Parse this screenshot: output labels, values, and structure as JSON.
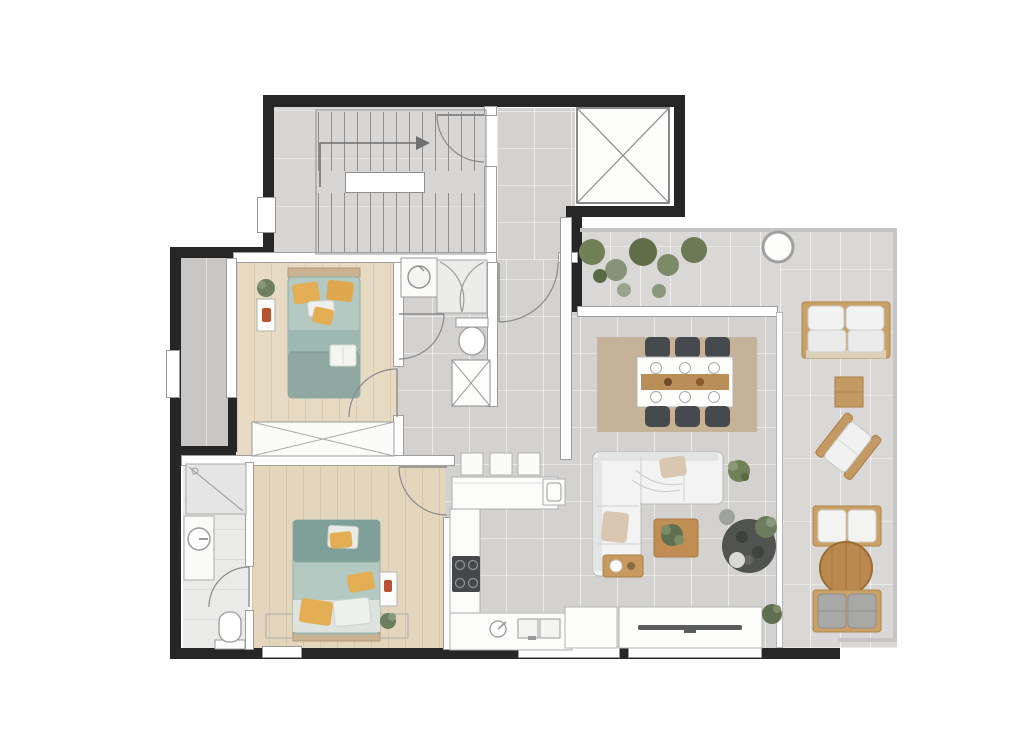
{
  "title": "Two-bedroom apartment floor plan with roof terrace",
  "colors": {
    "exterior_wall": "#262626",
    "interior_wall": "#ffffff",
    "tile_floor": "#d3d2d0",
    "wood_floor": "#e7dbc4",
    "terrace_floor": "#d9d8d6",
    "bedding_teal": "#a9c2bb",
    "bedding_teal_dark": "#7fa099",
    "pillow_yellow": "#e3ae54",
    "dining_rug_tan": "#c6b299",
    "furniture_wood": "#c49a64",
    "chair_dark": "#46494d",
    "plant_green": "#6b7a55"
  },
  "rooms": [
    {
      "id": "staircase-hall",
      "label": "communal staircase"
    },
    {
      "id": "elevator",
      "label": "elevator shaft"
    },
    {
      "id": "entry-corridor",
      "label": "entry corridor"
    },
    {
      "id": "utility-wc",
      "label": "utility / shower WC"
    },
    {
      "id": "bedroom-1",
      "label": "bedroom 1"
    },
    {
      "id": "bedroom-2",
      "label": "bedroom 2"
    },
    {
      "id": "bathroom",
      "label": "bathroom"
    },
    {
      "id": "kitchen",
      "label": "open kitchen"
    },
    {
      "id": "dining-area",
      "label": "dining area"
    },
    {
      "id": "living-area",
      "label": "living area"
    },
    {
      "id": "terrace",
      "label": "roof terrace"
    },
    {
      "id": "lightwell",
      "label": "side lightwell"
    }
  ],
  "furniture": [
    "u-shaped staircase with direction arrow",
    "elevator cross symbol",
    "washing machine",
    "curved shower enclosure",
    "toilet (x2)",
    "duct shaft",
    "double bed with teal bedding and yellow pillows (x2)",
    "nightstand with plant (x2)",
    "sliding wardrobe",
    "walk-in shower",
    "round washbasin vanity",
    "kitchen peninsula with 3 bar stools",
    "cooktop with 4 burners",
    "double kitchen sink",
    "dining table with 6 chairs on tan rug",
    "l-shaped sofa",
    "wooden coffee table with plant",
    "wooden side table",
    "tv sideboard",
    "large potted arrangement",
    "outdoor wooden sofa",
    "outdoor side table",
    "outdoor lounge chair",
    "two outdoor benches with round wooden table",
    "planter circle",
    "terrace plants"
  ]
}
